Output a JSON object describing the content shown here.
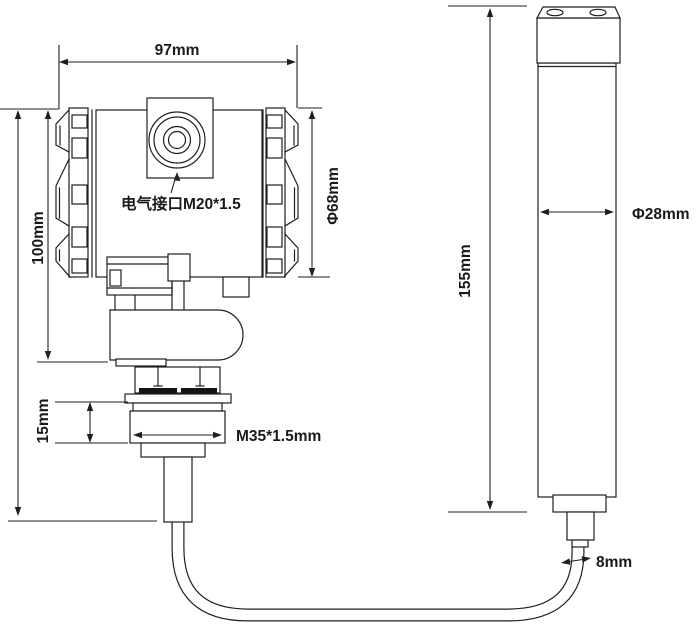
{
  "drawing": {
    "type": "engineering-dimension-drawing",
    "subject": "level transmitter with electrical housing and remote sensor probe connected by cable",
    "background_color": "#ffffff",
    "line_color": "#1f1f1f",
    "dimensions": {
      "housing_width": "97mm",
      "housing_height": "100mm",
      "housing_diameter": "Φ68mm",
      "electrical_interface": "电气接口M20*1.5",
      "nut_height": "15mm",
      "thread": "M35*1.5mm",
      "probe_length": "155mm",
      "probe_diameter": "Φ28mm",
      "cable_diameter": "8mm"
    }
  }
}
